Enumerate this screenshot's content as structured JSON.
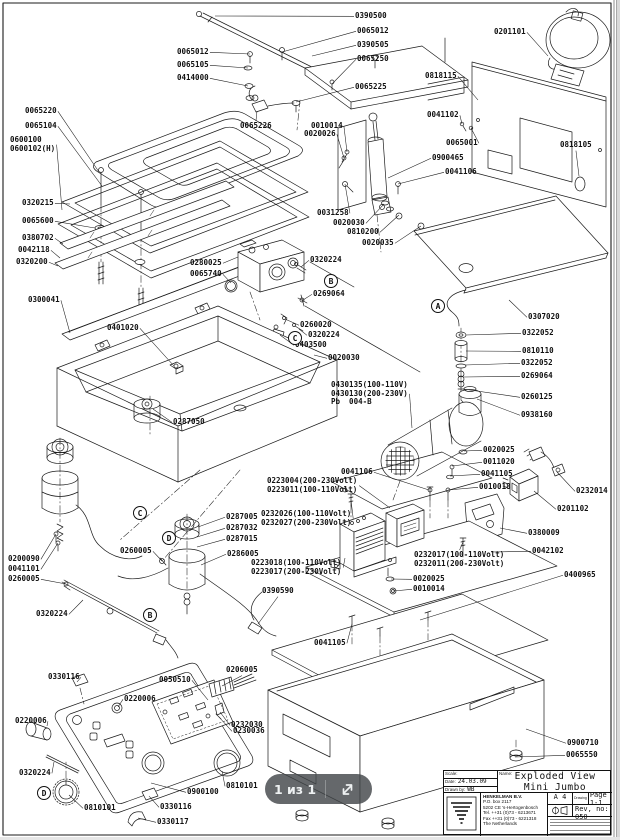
{
  "page": {
    "line_color": "#1b1b1b",
    "label_color": "#101010",
    "background": "#ffffff"
  },
  "overlay": {
    "page_indicator": "1 из 1",
    "expand_icon": "expand-diagonal-arrow-icon",
    "bg": "rgba(67,71,74,0.82)",
    "text_color": "#eef1f2"
  },
  "title_block": {
    "scale_label": "Scale:",
    "scale_value": "",
    "date_label": "Date:",
    "date_value": "24.03.09",
    "drawn_label": "Drawn by:",
    "drawn_value": "WB",
    "name_label": "Name:",
    "title_line1": "Exploded View",
    "title_line2": "Mini Jumbo",
    "company": {
      "name": "HENKELMAN B.V.",
      "address1": "P.O. box 2117",
      "address2": "5202 CE  's-Hertogenbosch",
      "tel": "Tel.  ++31 (0)73 - 6213671",
      "fax": "Fax  ++31 (0)73 - 6221318",
      "country": "The Netherlands"
    },
    "paper_size": "A 4",
    "drawing_label": "Drawing",
    "page_value": "Page  1-1",
    "rev_value": "Rev, no: 050"
  },
  "balloons": [
    {
      "letter": "A",
      "cx": 438,
      "cy": 306
    },
    {
      "letter": "B",
      "cx": 331,
      "cy": 281
    },
    {
      "letter": "C",
      "cx": 295,
      "cy": 338
    },
    {
      "letter": "C",
      "cx": 140,
      "cy": 513
    },
    {
      "letter": "D",
      "cx": 169,
      "cy": 538
    },
    {
      "letter": "B",
      "cx": 150,
      "cy": 615
    },
    {
      "letter": "D",
      "cx": 44,
      "cy": 793
    }
  ],
  "callouts": [
    {
      "t": "0390500",
      "x": 355,
      "y": 12,
      "s": "l",
      "tx": 215,
      "ty": 16
    },
    {
      "t": "0065012",
      "x": 357,
      "y": 27,
      "s": "l",
      "tx": 282,
      "ty": 52
    },
    {
      "t": "0390505",
      "x": 357,
      "y": 41,
      "s": "l",
      "tx": 312,
      "ty": 56
    },
    {
      "t": "0065250",
      "x": 357,
      "y": 55,
      "s": "l",
      "tx": 332,
      "ty": 84
    },
    {
      "t": "0065225",
      "x": 355,
      "y": 83,
      "s": "l",
      "tx": 296,
      "ty": 102
    },
    {
      "t": "0065012",
      "x": 177,
      "y": 48,
      "s": "r",
      "tx": 250,
      "ty": 54
    },
    {
      "t": "0065105",
      "x": 177,
      "y": 61,
      "s": "r",
      "tx": 248,
      "ty": 68
    },
    {
      "t": "0414000",
      "x": 177,
      "y": 74,
      "s": "r",
      "tx": 248,
      "ty": 86
    },
    {
      "t": "0201101",
      "x": 494,
      "y": 28,
      "s": "r",
      "tx": 548,
      "ty": 56
    },
    {
      "t": "0818115",
      "x": 425,
      "y": 72,
      "s": "r",
      "tx": 478,
      "ty": 100
    },
    {
      "t": "0041102",
      "x": 427,
      "y": 111,
      "s": "r",
      "tx": 462,
      "ty": 124
    },
    {
      "t": "0065001",
      "x": 446,
      "y": 139,
      "s": "r",
      "tx": 471,
      "ty": 128
    },
    {
      "t": "0818105",
      "x": 560,
      "y": 141,
      "s": "b",
      "tx": 579,
      "ty": 176
    },
    {
      "t": "0900465",
      "x": 432,
      "y": 154,
      "s": "l",
      "tx": 388,
      "ty": 178
    },
    {
      "t": "0041106",
      "x": 445,
      "y": 168,
      "s": "l",
      "tx": 398,
      "ty": 184
    },
    {
      "t": "0065220",
      "x": 25,
      "y": 107,
      "s": "r",
      "tx": 99,
      "ty": 172
    },
    {
      "t": "0065104",
      "x": 25,
      "y": 122,
      "s": "r",
      "tx": 102,
      "ty": 186
    },
    {
      "t": "0600100\n0600102(H)",
      "x": 10,
      "y": 136,
      "s": "r",
      "tx": 62,
      "ty": 210
    },
    {
      "t": "0320215",
      "x": 22,
      "y": 199,
      "s": "r",
      "tx": 70,
      "ty": 204
    },
    {
      "t": "0065600",
      "x": 22,
      "y": 217,
      "s": "r",
      "tx": 95,
      "ty": 228
    },
    {
      "t": "0380702",
      "x": 22,
      "y": 234,
      "s": "r",
      "tx": 63,
      "ty": 244
    },
    {
      "t": "0042118",
      "x": 18,
      "y": 246,
      "s": "r",
      "tx": 60,
      "ty": 258
    },
    {
      "t": "0320200",
      "x": 16,
      "y": 258,
      "s": "r",
      "tx": 58,
      "ty": 266
    },
    {
      "t": "0300041",
      "x": 28,
      "y": 296,
      "s": "r",
      "tx": 70,
      "ty": 333
    },
    {
      "t": "0065226",
      "x": 240,
      "y": 122,
      "s": "t",
      "tx": 257,
      "ty": 111
    },
    {
      "t": "0010014",
      "x": 311,
      "y": 122,
      "s": "r",
      "tx": 347,
      "ty": 152
    },
    {
      "t": "0020026",
      "x": 304,
      "y": 130,
      "s": "r",
      "tx": 344,
      "ty": 158
    },
    {
      "t": "0031258",
      "x": 317,
      "y": 209,
      "s": "r",
      "tx": 345,
      "ty": 184
    },
    {
      "t": "0020030",
      "x": 333,
      "y": 219,
      "s": "r",
      "tx": 384,
      "ty": 204
    },
    {
      "t": "0810200",
      "x": 347,
      "y": 228,
      "s": "r",
      "tx": 399,
      "ty": 215
    },
    {
      "t": "0020035",
      "x": 362,
      "y": 239,
      "s": "r",
      "tx": 421,
      "ty": 226
    },
    {
      "t": "0280025",
      "x": 190,
      "y": 259,
      "s": "r",
      "tx": 238,
      "ty": 257
    },
    {
      "t": "0065740",
      "x": 190,
      "y": 270,
      "s": "r",
      "tx": 231,
      "ty": 283
    },
    {
      "t": "0320224",
      "x": 310,
      "y": 256,
      "s": "l",
      "tx": 301,
      "ty": 267
    },
    {
      "t": "0269064",
      "x": 313,
      "y": 290,
      "s": "l",
      "tx": 303,
      "ty": 300
    },
    {
      "t": "0260020",
      "x": 300,
      "y": 321,
      "s": "l",
      "tx": 285,
      "ty": 319
    },
    {
      "t": "0320224",
      "x": 308,
      "y": 331,
      "s": "l",
      "tx": 299,
      "ty": 329
    },
    {
      "t": "0403500",
      "x": 295,
      "y": 341,
      "s": "l",
      "tx": 280,
      "ty": 335
    },
    {
      "t": "0020030",
      "x": 328,
      "y": 354,
      "s": "l",
      "tx": 314,
      "ty": 355
    },
    {
      "t": "0401020",
      "x": 107,
      "y": 324,
      "s": "r",
      "tx": 174,
      "ty": 366
    },
    {
      "t": "0287050",
      "x": 173,
      "y": 418,
      "s": "l",
      "tx": 153,
      "ty": 409
    },
    {
      "t": "0307020",
      "x": 528,
      "y": 313,
      "s": "l",
      "tx": 509,
      "ty": 300
    },
    {
      "t": "0322052",
      "x": 522,
      "y": 329,
      "s": "l",
      "tx": 466,
      "ty": 335
    },
    {
      "t": "0810110",
      "x": 522,
      "y": 347,
      "s": "l",
      "tx": 466,
      "ty": 351
    },
    {
      "t": "0322052",
      "x": 521,
      "y": 359,
      "s": "l",
      "tx": 465,
      "ty": 365
    },
    {
      "t": "0269064",
      "x": 521,
      "y": 372,
      "s": "l",
      "tx": 464,
      "ty": 377
    },
    {
      "t": "0260125",
      "x": 521,
      "y": 393,
      "s": "l",
      "tx": 463,
      "ty": 389
    },
    {
      "t": "0938160",
      "x": 521,
      "y": 411,
      "s": "l",
      "tx": 477,
      "ty": 399
    },
    {
      "t": "0430135(100-110V)\n0430130(200-230V)\nPb  004-B",
      "x": 331,
      "y": 381,
      "s": "r",
      "tx": 412,
      "ty": 428
    },
    {
      "t": "0041106",
      "x": 341,
      "y": 468,
      "s": "r",
      "tx": 429,
      "ty": 490
    },
    {
      "t": "0020025",
      "x": 483,
      "y": 446,
      "s": "l",
      "tx": 464,
      "ty": 451
    },
    {
      "t": "0011020",
      "x": 483,
      "y": 458,
      "s": "l",
      "tx": 452,
      "ty": 466
    },
    {
      "t": "0041105",
      "x": 481,
      "y": 470,
      "s": "l",
      "tx": 450,
      "ty": 476
    },
    {
      "t": "0010018",
      "x": 479,
      "y": 483,
      "s": "l",
      "tx": 448,
      "ty": 490
    },
    {
      "t": "0232014",
      "x": 576,
      "y": 487,
      "s": "l",
      "tx": 557,
      "ty": 472
    },
    {
      "t": "0201102",
      "x": 557,
      "y": 505,
      "s": "l",
      "tx": 534,
      "ty": 491
    },
    {
      "t": "0380009",
      "x": 528,
      "y": 529,
      "s": "l",
      "tx": 500,
      "ty": 528
    },
    {
      "t": "0042102",
      "x": 532,
      "y": 547,
      "s": "l",
      "tx": 491,
      "ty": 552
    },
    {
      "t": "0400965",
      "x": 564,
      "y": 571,
      "s": "l",
      "tx": 420,
      "ty": 620
    },
    {
      "t": "0223004(200-230Volt)\n0223011(100-110Volt)",
      "x": 267,
      "y": 477,
      "s": "r",
      "tx": 390,
      "ty": 508
    },
    {
      "t": "0232026(100-110Volt)\n0232027(200-230Volt)",
      "x": 261,
      "y": 510,
      "s": "r",
      "tx": 351,
      "ty": 500
    },
    {
      "t": "0287005",
      "x": 226,
      "y": 513,
      "s": "l",
      "tx": 198,
      "ty": 527
    },
    {
      "t": "0287032",
      "x": 226,
      "y": 524,
      "s": "l",
      "tx": 197,
      "ty": 537
    },
    {
      "t": "0287015",
      "x": 226,
      "y": 535,
      "s": "l",
      "tx": 197,
      "ty": 547
    },
    {
      "t": "0286005",
      "x": 227,
      "y": 550,
      "s": "l",
      "tx": 201,
      "ty": 565
    },
    {
      "t": "0223018(100-110Volt)\n0223017(200-230Volt)",
      "x": 251,
      "y": 559,
      "s": "r",
      "tx": 345,
      "ty": 558
    },
    {
      "t": "0232017(100-110Volt)\n0232011(200-230Volt)",
      "x": 414,
      "y": 551,
      "s": "t",
      "tx": 463,
      "ty": 542
    },
    {
      "t": "0020025",
      "x": 413,
      "y": 575,
      "s": "l",
      "tx": 391,
      "ty": 579
    },
    {
      "t": "0010014",
      "x": 413,
      "y": 585,
      "s": "l",
      "tx": 393,
      "ty": 591
    },
    {
      "t": "0200090",
      "x": 8,
      "y": 555,
      "s": "r",
      "tx": 56,
      "ty": 534
    },
    {
      "t": "0041101",
      "x": 8,
      "y": 565,
      "s": "r",
      "tx": 58,
      "ty": 543
    },
    {
      "t": "0260005",
      "x": 8,
      "y": 575,
      "s": "r",
      "tx": 66,
      "ty": 584
    },
    {
      "t": "0260005",
      "x": 120,
      "y": 547,
      "s": "r",
      "tx": 162,
      "ty": 561
    },
    {
      "t": "0320224",
      "x": 36,
      "y": 610,
      "s": "r",
      "tx": 83,
      "ty": 600
    },
    {
      "t": "0390590",
      "x": 262,
      "y": 587,
      "s": "b",
      "tx": 258,
      "ty": 624
    },
    {
      "t": "0041105",
      "x": 314,
      "y": 639,
      "s": "r",
      "tx": 352,
      "ty": 624
    },
    {
      "t": "0900710",
      "x": 567,
      "y": 739,
      "s": "l",
      "tx": 526,
      "ty": 729
    },
    {
      "t": "0065550",
      "x": 566,
      "y": 751,
      "s": "l",
      "tx": 515,
      "ty": 757
    },
    {
      "t": "0330116",
      "x": 48,
      "y": 673,
      "s": "r",
      "tx": 77,
      "ty": 682
    },
    {
      "t": "0050510",
      "x": 159,
      "y": 676,
      "s": "r",
      "tx": 208,
      "ty": 700
    },
    {
      "t": "0206005",
      "x": 226,
      "y": 666,
      "s": "b",
      "tx": 222,
      "ty": 686
    },
    {
      "t": "0220006",
      "x": 124,
      "y": 695,
      "s": "l",
      "tx": 118,
      "ty": 707
    },
    {
      "t": "0220006",
      "x": 15,
      "y": 717,
      "s": "r",
      "tx": 47,
      "ty": 726
    },
    {
      "t": "0232030",
      "x": 231,
      "y": 721,
      "s": "l",
      "tx": 220,
      "ty": 712
    },
    {
      "t": "0230036",
      "x": 233,
      "y": 727,
      "s": "l",
      "tx": 219,
      "ty": 717
    },
    {
      "t": "0320224",
      "x": 19,
      "y": 769,
      "s": "r",
      "tx": 54,
      "ty": 762
    },
    {
      "t": "0810101",
      "x": 84,
      "y": 804,
      "s": "l",
      "tx": 69,
      "ty": 795
    },
    {
      "t": "0900100",
      "x": 187,
      "y": 788,
      "s": "l",
      "tx": 151,
      "ty": 783
    },
    {
      "t": "0810101",
      "x": 226,
      "y": 782,
      "s": "l",
      "tx": 222,
      "ty": 771
    },
    {
      "t": "0330116",
      "x": 160,
      "y": 803,
      "s": "l",
      "tx": 149,
      "ty": 796
    },
    {
      "t": "0330117",
      "x": 157,
      "y": 818,
      "s": "l",
      "tx": 138,
      "ty": 818
    }
  ]
}
